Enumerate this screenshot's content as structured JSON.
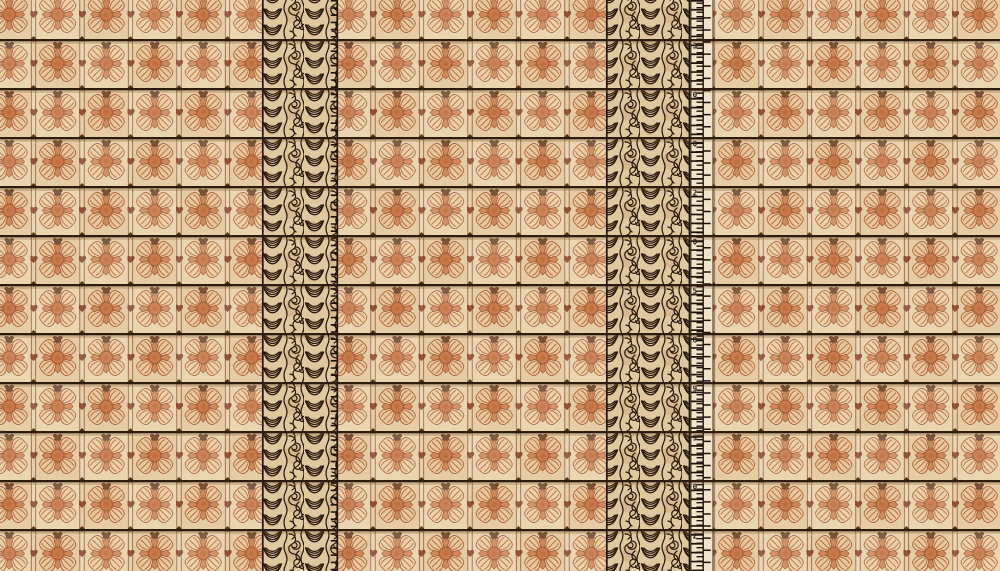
{
  "watermark": {
    "text": "Adobe Stock | #1432282149"
  },
  "ruler": {
    "digits": [
      "3",
      "0",
      "0",
      "2",
      "0",
      "5",
      "8",
      "9",
      "9",
      "0",
      "2"
    ]
  },
  "palette": {
    "tile_cream": "#ecd7b0",
    "petal_fill": "#eed3a8",
    "petal_stroke": "#a6603d",
    "petal_vein": "#bb7047",
    "flower_center": "#c97b4b",
    "accent_heart": "#84402a",
    "grout_dark": "#2c1b0d",
    "swirl_bg": "#e2cba1",
    "swirl_line": "#271608",
    "ruler_bg": "#f2e8cb",
    "tick_black": "#1b1109",
    "watermark_gray": "#322c28"
  }
}
